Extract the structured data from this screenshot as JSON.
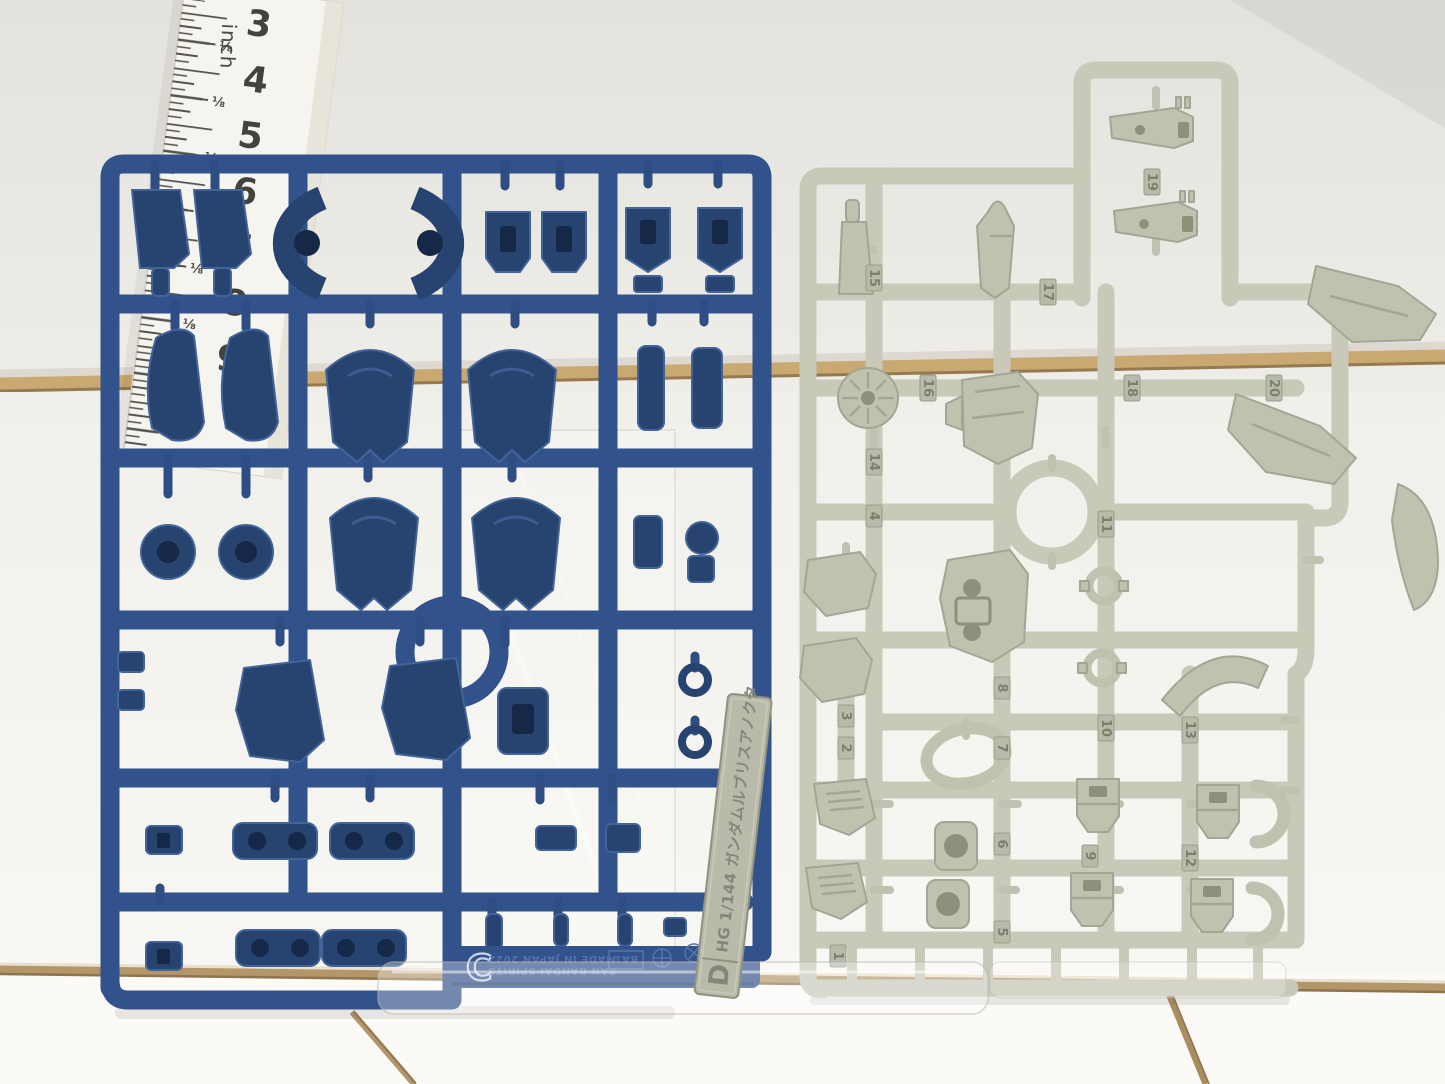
{
  "ruler": {
    "unit_label": "inch",
    "numbers": [
      "3",
      "4",
      "5",
      "6",
      "7",
      "8",
      "9"
    ],
    "fraction_label": "⅛"
  },
  "blue_sprue": {
    "runner_letter": "C",
    "mold_text_line1": "BAN BANDAI SPIRITS",
    "mold_text_line2": "MADE IN JAPAN 2022",
    "mold_code": "BA1",
    "plastic_color": "#31528a"
  },
  "gray_sprue": {
    "plastic_color": "#c8c9b9",
    "part_numbers": [
      "1",
      "2",
      "3",
      "4",
      "5",
      "6",
      "7",
      "8",
      "9",
      "10",
      "11",
      "12",
      "13",
      "14",
      "15",
      "16",
      "17",
      "18",
      "19",
      "20"
    ]
  },
  "label_tag": {
    "runner_letter": "D",
    "text": "HG 1/144 ガンダムルブリスアノクタ"
  },
  "background": {
    "wall_color": "#e6e4df",
    "tile_color": "#fbfaf7",
    "grout_color": "#b3966a"
  }
}
